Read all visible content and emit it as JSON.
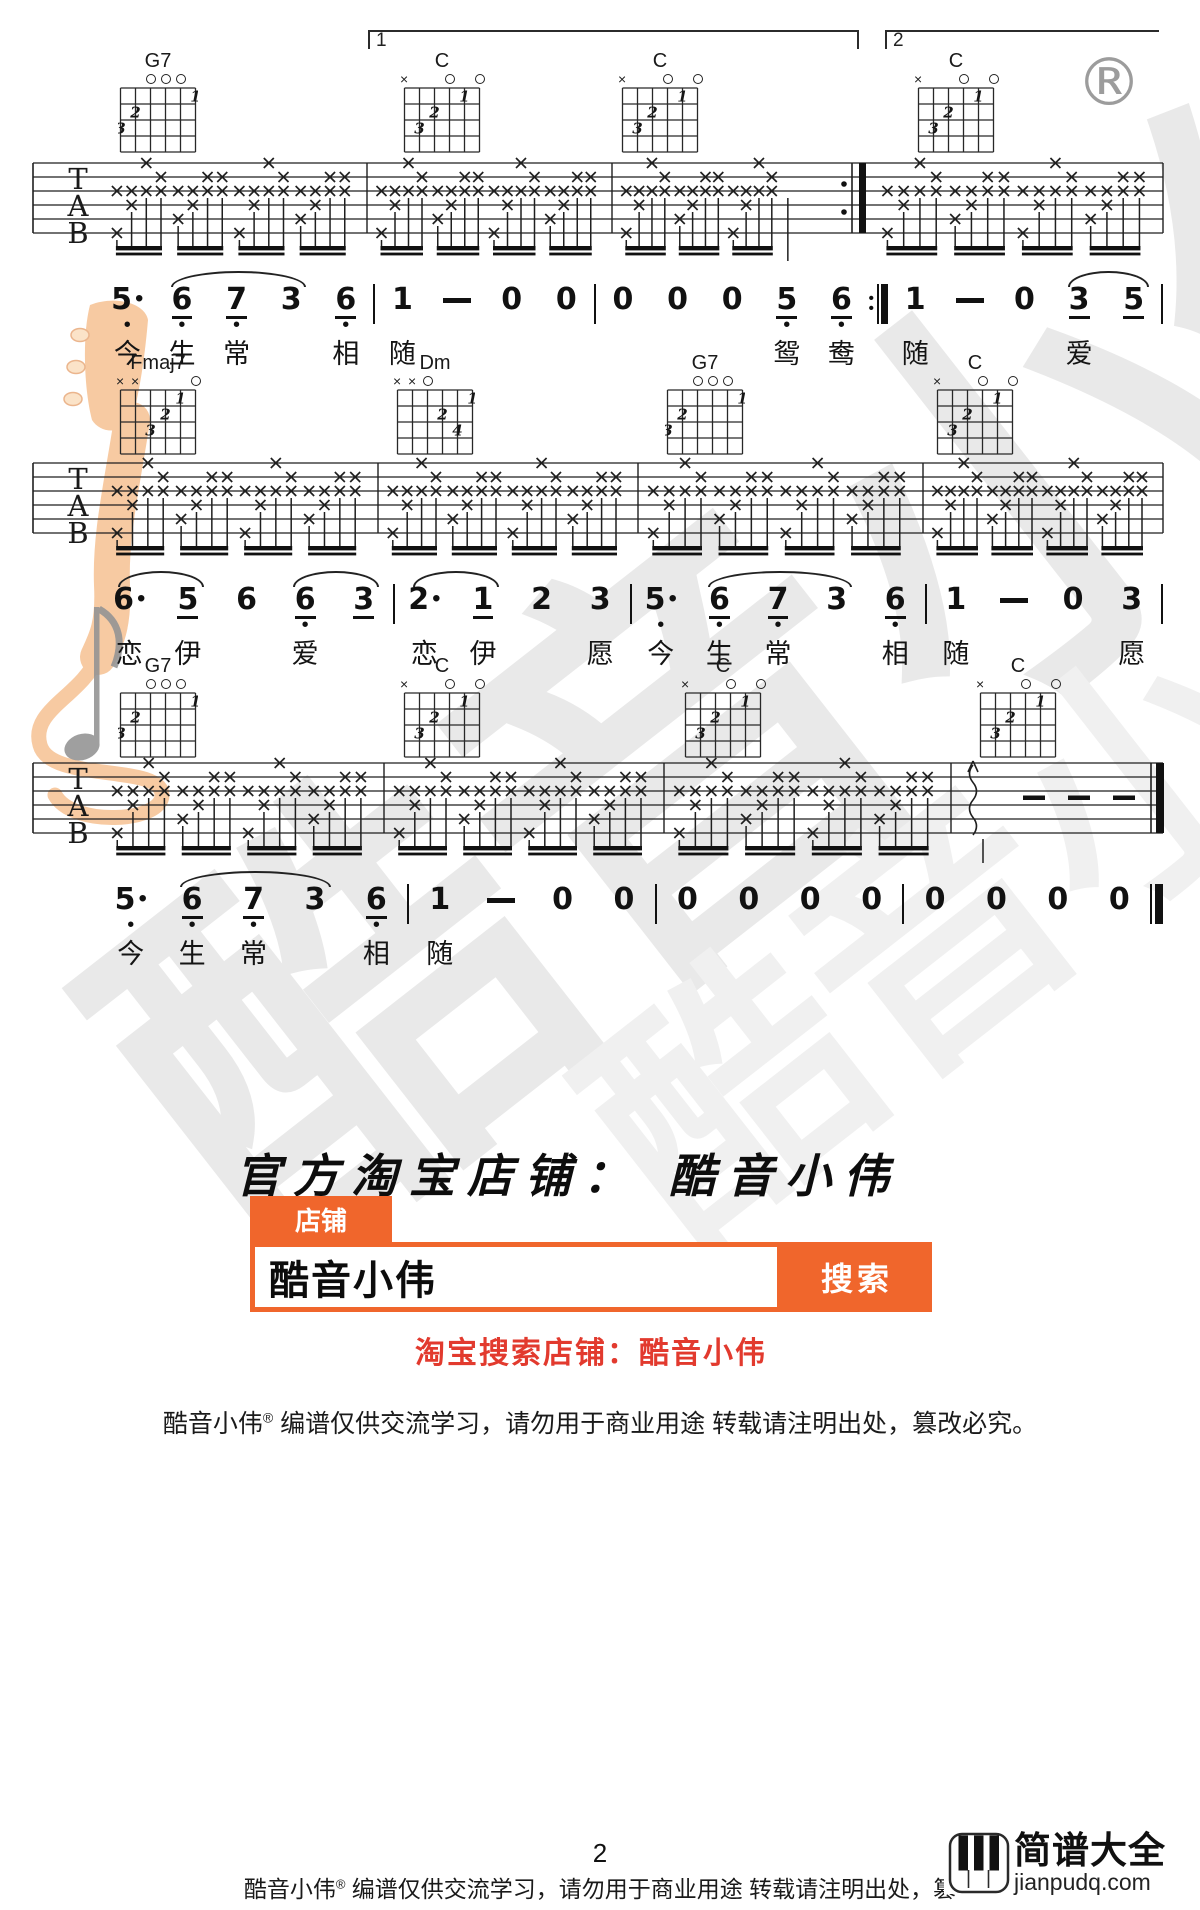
{
  "page": {
    "registered_mark": "®"
  },
  "watermark": {
    "text": "酷音小伟",
    "color": "#e9e9e9"
  },
  "score": {
    "staff_letters": [
      "T",
      "A",
      "B"
    ],
    "mark_glyph": "×",
    "volta": {
      "first": "1",
      "second": "2"
    },
    "chord_shapes": {
      "G7": {
        "markers": [
          "",
          "",
          "o",
          "o",
          "o",
          ""
        ],
        "fingers": [
          [
            6,
            3,
            "3"
          ],
          [
            5,
            2,
            "2"
          ],
          [
            1,
            1,
            "1"
          ]
        ]
      },
      "C": {
        "markers": [
          "x",
          "",
          "",
          "o",
          "",
          "o"
        ],
        "fingers": [
          [
            5,
            3,
            "3"
          ],
          [
            4,
            2,
            "2"
          ],
          [
            2,
            1,
            "1"
          ]
        ]
      },
      "Fmaj7": {
        "markers": [
          "x",
          "x",
          "",
          "",
          "",
          "o"
        ],
        "fingers": [
          [
            4,
            3,
            "3"
          ],
          [
            3,
            2,
            "2"
          ],
          [
            2,
            1,
            "1"
          ]
        ]
      },
      "Dm": {
        "markers": [
          "x",
          "x",
          "o",
          "",
          "",
          ""
        ],
        "fingers": [
          [
            1,
            1,
            "1"
          ],
          [
            3,
            2,
            "2"
          ],
          [
            2,
            3,
            "4"
          ]
        ]
      }
    },
    "systems": [
      {
        "volta": true,
        "chords_y": 50,
        "tab_y": 149,
        "jp_y": 284,
        "chords": [
          {
            "name": "G7",
            "x": 118
          },
          {
            "name": "C",
            "x": 402
          },
          {
            "name": "C",
            "x": 620
          },
          {
            "name": "C",
            "x": 916
          }
        ],
        "tab": {
          "start": 108,
          "bars": [
            367,
            612,
            862,
            1163
          ],
          "repeat_end": 862,
          "measures": [
            {
              "g": 4
            },
            {
              "g": 4
            },
            {
              "g": 3,
              "lone": true
            },
            {
              "g": 4
            }
          ]
        },
        "jianpu": [
          {
            "tokens": [
              {
                "d": "5",
                "dot": 1,
                "low": 1,
                "lyr": "今"
              },
              {
                "d": "6",
                "u": 1,
                "low": 1,
                "lyr": "生",
                "arc": 2
              },
              {
                "d": "7",
                "u": 1,
                "low": 1,
                "lyr": "常"
              },
              {
                "d": "3"
              },
              {
                "d": "6",
                "u": 1,
                "low": 1,
                "lyr": "相"
              }
            ]
          },
          {
            "tokens": [
              {
                "d": "1",
                "lyr": "随"
              },
              {
                "d": "-"
              },
              {
                "d": "0"
              },
              {
                "d": "0"
              }
            ]
          },
          {
            "tokens": [
              {
                "d": "0"
              },
              {
                "d": "0"
              },
              {
                "d": "0"
              },
              {
                "d": "5",
                "u": 1,
                "low": 1,
                "lyr": "鸳"
              },
              {
                "d": "6",
                "u": 1,
                "low": 1,
                "lyr": "鸯"
              }
            ],
            "endbar": "repeat"
          },
          {
            "tokens": [
              {
                "d": "1",
                "lyr": "随"
              },
              {
                "d": "-"
              },
              {
                "d": "0"
              },
              {
                "d": "3",
                "u": 1,
                "lyr": "爱",
                "arc": 1
              },
              {
                "d": "5",
                "u": 1
              }
            ]
          }
        ]
      },
      {
        "chords_y": 352,
        "tab_y": 449,
        "jp_y": 584,
        "chords": [
          {
            "name": "Fmaj7",
            "x": 118
          },
          {
            "name": "Dm",
            "x": 395
          },
          {
            "name": "G7",
            "x": 665
          },
          {
            "name": "C",
            "x": 935
          }
        ],
        "tab": {
          "start": 108,
          "bars": [
            378,
            638,
            923,
            1163
          ],
          "measures": [
            {
              "g": 4
            },
            {
              "g": 4
            },
            {
              "g": 4
            },
            {
              "g": 4
            }
          ]
        },
        "jianpu": [
          {
            "tokens": [
              {
                "d": "6",
                "dot": 1,
                "lyr": "恋",
                "arc": 1
              },
              {
                "d": "5",
                "u": 1,
                "lyr": "伊"
              },
              {
                "d": "6"
              },
              {
                "d": "6",
                "u": 1,
                "low": 1,
                "lyr": "爱",
                "arc": 1
              },
              {
                "d": "3",
                "u": 1
              }
            ]
          },
          {
            "tokens": [
              {
                "d": "2",
                "dot": 1,
                "lyr": "恋",
                "arc": 1
              },
              {
                "d": "1",
                "u": 1,
                "lyr": "伊"
              },
              {
                "d": "2"
              },
              {
                "d": "3",
                "lyr": "愿"
              }
            ]
          },
          {
            "tokens": [
              {
                "d": "5",
                "dot": 1,
                "low": 1,
                "lyr": "今"
              },
              {
                "d": "6",
                "u": 1,
                "low": 1,
                "lyr": "生",
                "arc": 2
              },
              {
                "d": "7",
                "u": 1,
                "low": 1,
                "lyr": "常"
              },
              {
                "d": "3"
              },
              {
                "d": "6",
                "u": 1,
                "low": 1,
                "lyr": "相"
              }
            ]
          },
          {
            "tokens": [
              {
                "d": "1",
                "lyr": "随"
              },
              {
                "d": "-"
              },
              {
                "d": "0"
              },
              {
                "d": "3",
                "lyr": "愿"
              }
            ]
          }
        ]
      },
      {
        "chords_y": 655,
        "tab_y": 749,
        "jp_y": 884,
        "chords": [
          {
            "name": "G7",
            "x": 118
          },
          {
            "name": "C",
            "x": 402
          },
          {
            "name": "C",
            "x": 683
          },
          {
            "name": "C",
            "x": 978
          }
        ],
        "tab": {
          "start": 108,
          "bars": [
            384,
            664,
            951,
            1163
          ],
          "final_end": true,
          "measures": [
            {
              "g": 4
            },
            {
              "g": 4
            },
            {
              "g": 4
            },
            {
              "arp": true
            }
          ]
        },
        "jianpu": [
          {
            "tokens": [
              {
                "d": "5",
                "dot": 1,
                "low": 1,
                "lyr": "今"
              },
              {
                "d": "6",
                "u": 1,
                "low": 1,
                "lyr": "生",
                "arc": 2
              },
              {
                "d": "7",
                "u": 1,
                "low": 1,
                "lyr": "常"
              },
              {
                "d": "3"
              },
              {
                "d": "6",
                "u": 1,
                "low": 1,
                "lyr": "相"
              }
            ]
          },
          {
            "tokens": [
              {
                "d": "1",
                "lyr": "随"
              },
              {
                "d": "-"
              },
              {
                "d": "0"
              },
              {
                "d": "0"
              }
            ]
          },
          {
            "tokens": [
              {
                "d": "0"
              },
              {
                "d": "0"
              },
              {
                "d": "0"
              },
              {
                "d": "0"
              }
            ]
          },
          {
            "tokens": [
              {
                "d": "0"
              },
              {
                "d": "0"
              },
              {
                "d": "0"
              },
              {
                "d": "0"
              }
            ],
            "endbar": "final"
          }
        ]
      }
    ]
  },
  "shop": {
    "title": "官方淘宝店铺：  酷音小伟",
    "tab_label": "店铺",
    "search_value": "酷音小伟",
    "search_button": "搜索",
    "red_note": "淘宝搜索店铺：酷音小伟",
    "orange": "#f0662c",
    "red": "#e23a2e"
  },
  "disclaimer": {
    "brand": "酷音小伟",
    "reg": "®",
    "text": "编谱仅供交流学习，请勿用于商业用途 转载请注明出处，篡改必究。"
  },
  "footer": {
    "page_number": "2",
    "brand": "酷音小伟",
    "reg": "®",
    "text": "编谱仅供交流学习，请勿用于商业用途 转载请注明出处，篡",
    "logo_title": "简谱大全",
    "logo_domain": "jianpudq.com"
  }
}
